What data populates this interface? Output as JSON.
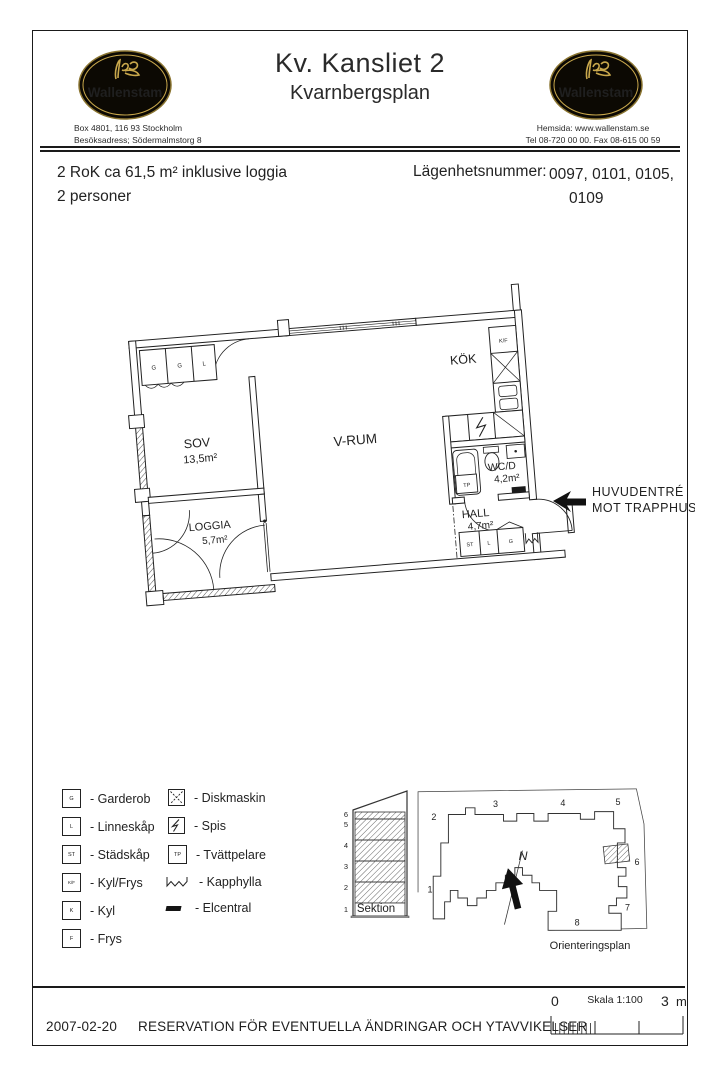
{
  "header": {
    "brand": "Wallenstam",
    "title": "Kv. Kansliet 2",
    "subtitle": "Kvarnbergsplan",
    "left_contact_line1": "Box 4801, 116 93 Stockholm",
    "left_contact_line2": "Besöksadress; Södermalmstorg 8",
    "right_contact_line1": "Hemsida: www.wallenstam.se",
    "right_contact_line2": "Tel 08-720 00 00. Fax 08-615 00 59"
  },
  "info": {
    "size_line": "2 RoK ca 61,5 m² inklusive loggia",
    "persons_line": "2 personer",
    "apartment_label": "Lägenhetsnummer:",
    "apartment_numbers_line1": "0097, 0101, 0105,",
    "apartment_numbers_line2": "0109"
  },
  "floorplan": {
    "rooms": {
      "sov": {
        "name": "SOV",
        "area": "13,5m²"
      },
      "vrum": {
        "name": "V-RUM"
      },
      "kok": {
        "name": "KÖK"
      },
      "wcd": {
        "name": "WC/D",
        "area": "4,2m²"
      },
      "hall": {
        "name": "HALL",
        "area": "4,7m²"
      },
      "loggia": {
        "name": "LOGGIA",
        "area": "5,7m²"
      }
    },
    "labels": {
      "kf": "K/F",
      "tp": "TP",
      "wardrobes": [
        "G",
        "G",
        "L"
      ],
      "hall_cabinets": [
        "ST",
        "L",
        "G"
      ]
    },
    "entrance": {
      "line1": "HUVUDENTRÉ",
      "line2": "MOT TRAPPHUS"
    }
  },
  "legend": {
    "col1": [
      {
        "sym": "G",
        "label": "- Garderob"
      },
      {
        "sym": "L",
        "label": "- Linneskåp"
      },
      {
        "sym": "ST",
        "label": "- Städskåp"
      },
      {
        "sym": "K/F",
        "label": "- Kyl/Frys"
      },
      {
        "sym": "K",
        "label": "- Kyl"
      },
      {
        "sym": "F",
        "label": "- Frys"
      }
    ],
    "col2": [
      {
        "sym": "diskmaskin-icon",
        "label": "- Diskmaskin"
      },
      {
        "sym": "spis-icon",
        "label": "- Spis"
      },
      {
        "sym": "TP",
        "label": "- Tvättpelare"
      },
      {
        "sym": "kapphylla-icon",
        "label": "- Kapphylla"
      },
      {
        "sym": "elcentral-icon",
        "label": "- Elcentral"
      }
    ]
  },
  "section": {
    "floors": [
      "6",
      "5",
      "4",
      "3",
      "2",
      "1"
    ],
    "label": "Sektion"
  },
  "orientation": {
    "buildings": [
      "1",
      "2",
      "3",
      "4",
      "5",
      "6",
      "7",
      "8"
    ],
    "north": "N",
    "label": "Orienteringsplan"
  },
  "scalebar": {
    "zero": "0",
    "label": "Skala 1:100",
    "max": "3",
    "unit": "m"
  },
  "footer": {
    "date": "2007-02-20",
    "disclaimer": "RESERVATION FÖR EVENTUELLA ÄNDRINGAR OCH YTAVVIKELSER"
  },
  "colors": {
    "logo_gold": "#c9a84c",
    "logo_bg": "#0c0903",
    "ink": "#1a1a1a"
  }
}
